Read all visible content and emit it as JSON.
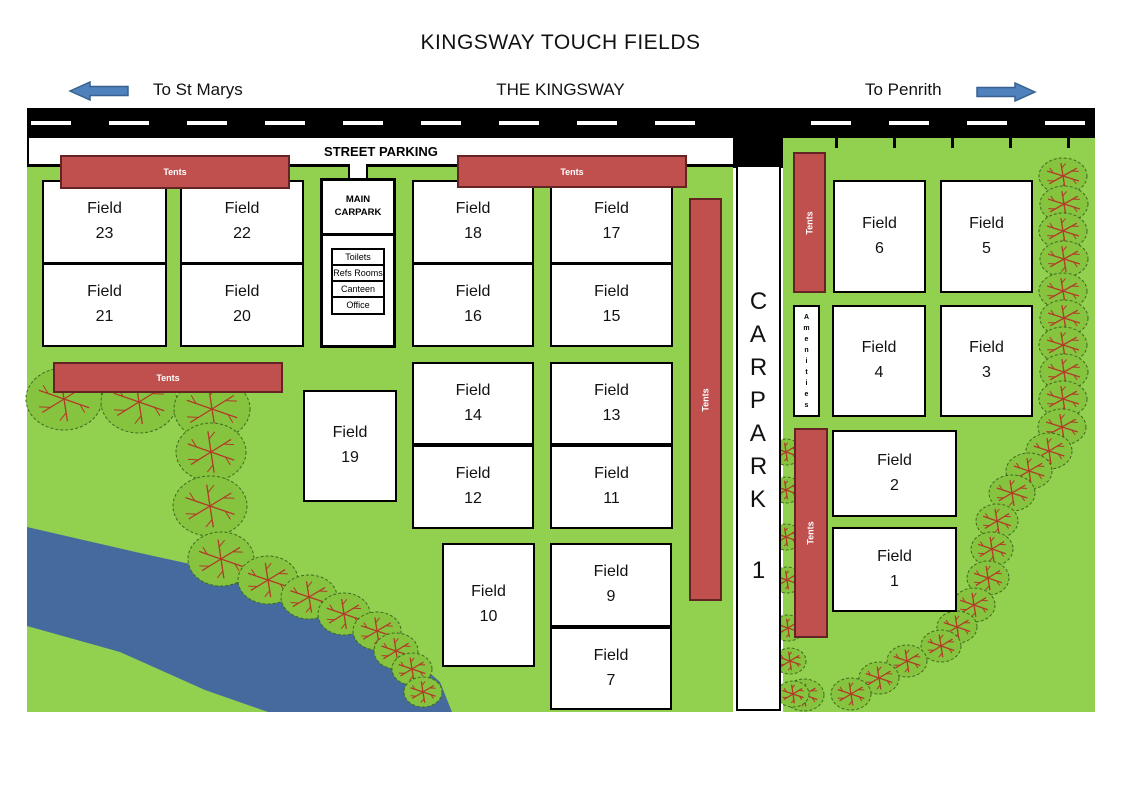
{
  "title": "KINGSWAY TOUCH FIELDS",
  "road": {
    "left_label": "To St Marys",
    "center_label": "THE KINGSWAY",
    "right_label": "To Penrith"
  },
  "street_parking_label": "STREET PARKING",
  "carpark1": {
    "letters": "CARPARK",
    "number": "1"
  },
  "main_carpark": {
    "label": "MAIN CARPARK",
    "rooms": [
      "Toilets",
      "Refs Rooms",
      "Canteen",
      "Office"
    ]
  },
  "amenities_label": "Amenities",
  "tents_label": "Tents",
  "field_word": "Field",
  "fields": [
    {
      "num": "23",
      "x": 42,
      "y": 180,
      "w": 125,
      "h": 84
    },
    {
      "num": "22",
      "x": 180,
      "y": 180,
      "w": 124,
      "h": 84
    },
    {
      "num": "21",
      "x": 42,
      "y": 263,
      "w": 125,
      "h": 84
    },
    {
      "num": "20",
      "x": 180,
      "y": 263,
      "w": 124,
      "h": 84
    },
    {
      "num": "18",
      "x": 412,
      "y": 180,
      "w": 122,
      "h": 84
    },
    {
      "num": "17",
      "x": 550,
      "y": 180,
      "w": 123,
      "h": 84
    },
    {
      "num": "16",
      "x": 412,
      "y": 263,
      "w": 122,
      "h": 84
    },
    {
      "num": "15",
      "x": 550,
      "y": 263,
      "w": 123,
      "h": 84
    },
    {
      "num": "14",
      "x": 412,
      "y": 362,
      "w": 122,
      "h": 83
    },
    {
      "num": "13",
      "x": 550,
      "y": 362,
      "w": 123,
      "h": 83
    },
    {
      "num": "12",
      "x": 412,
      "y": 445,
      "w": 122,
      "h": 84
    },
    {
      "num": "11",
      "x": 550,
      "y": 445,
      "w": 123,
      "h": 84
    },
    {
      "num": "19",
      "x": 303,
      "y": 390,
      "w": 94,
      "h": 112
    },
    {
      "num": "10",
      "x": 442,
      "y": 543,
      "w": 93,
      "h": 124
    },
    {
      "num": "9",
      "x": 550,
      "y": 543,
      "w": 122,
      "h": 84
    },
    {
      "num": "7",
      "x": 550,
      "y": 627,
      "w": 122,
      "h": 83
    },
    {
      "num": "6",
      "x": 833,
      "y": 180,
      "w": 93,
      "h": 113
    },
    {
      "num": "5",
      "x": 940,
      "y": 180,
      "w": 93,
      "h": 113
    },
    {
      "num": "4",
      "x": 832,
      "y": 305,
      "w": 94,
      "h": 112
    },
    {
      "num": "3",
      "x": 940,
      "y": 305,
      "w": 93,
      "h": 112
    },
    {
      "num": "2",
      "x": 832,
      "y": 430,
      "w": 125,
      "h": 87
    },
    {
      "num": "1",
      "x": 832,
      "y": 527,
      "w": 125,
      "h": 85
    }
  ],
  "tents": [
    {
      "x": 60,
      "y": 155,
      "w": 230,
      "h": 34,
      "vertical": false
    },
    {
      "x": 457,
      "y": 155,
      "w": 230,
      "h": 33,
      "vertical": false
    },
    {
      "x": 53,
      "y": 362,
      "w": 230,
      "h": 31,
      "vertical": false
    },
    {
      "x": 689,
      "y": 198,
      "w": 33,
      "h": 403,
      "vertical": true
    },
    {
      "x": 793,
      "y": 152,
      "w": 33,
      "h": 141,
      "vertical": true
    },
    {
      "x": 794,
      "y": 428,
      "w": 34,
      "h": 210,
      "vertical": true
    }
  ],
  "trees": [
    [
      64,
      399,
      38,
      31
    ],
    [
      139,
      402,
      38,
      31
    ],
    [
      212,
      409,
      38,
      31
    ],
    [
      211,
      452,
      35,
      29
    ],
    [
      210,
      506,
      37,
      30
    ],
    [
      221,
      559,
      33,
      27
    ],
    [
      268,
      580,
      30,
      24
    ],
    [
      309,
      597,
      28,
      22
    ],
    [
      344,
      614,
      26,
      21
    ],
    [
      377,
      631,
      24,
      19
    ],
    [
      396,
      651,
      22,
      18
    ],
    [
      412,
      669,
      20,
      16
    ],
    [
      423,
      692,
      19,
      15
    ],
    [
      1063,
      176,
      24,
      18
    ],
    [
      1064,
      204,
      24,
      18
    ],
    [
      1063,
      231,
      24,
      18
    ],
    [
      1064,
      259,
      24,
      18
    ],
    [
      1063,
      291,
      24,
      18
    ],
    [
      1064,
      318,
      24,
      18
    ],
    [
      1063,
      345,
      24,
      18
    ],
    [
      1064,
      372,
      24,
      18
    ],
    [
      1063,
      399,
      24,
      18
    ],
    [
      1062,
      427,
      24,
      18
    ],
    [
      1049,
      451,
      23,
      18
    ],
    [
      1029,
      471,
      23,
      18
    ],
    [
      1012,
      493,
      23,
      18
    ],
    [
      997,
      521,
      21,
      17
    ],
    [
      992,
      549,
      21,
      17
    ],
    [
      988,
      578,
      21,
      17
    ],
    [
      974,
      605,
      21,
      17
    ],
    [
      957,
      627,
      20,
      16
    ],
    [
      941,
      646,
      20,
      16
    ],
    [
      907,
      661,
      20,
      16
    ],
    [
      879,
      678,
      20,
      16
    ],
    [
      851,
      694,
      20,
      16
    ],
    [
      804,
      695,
      20,
      16
    ],
    [
      786,
      452,
      16,
      13
    ],
    [
      786,
      490,
      16,
      13
    ],
    [
      786,
      537,
      16,
      13
    ],
    [
      787,
      580,
      16,
      13
    ],
    [
      788,
      628,
      16,
      13
    ],
    [
      790,
      661,
      16,
      13
    ],
    [
      793,
      694,
      16,
      13
    ]
  ],
  "parking_ticks_x": [
    835,
    893,
    951,
    1009,
    1067
  ],
  "river_points": "27,527 140,553 240,575 330,612 400,647 440,682 452,712 268,712 205,690 120,652 27,626",
  "colors": {
    "grass": "#92D050",
    "tree": "#86C440",
    "tree_stroke": "#3E6B1E",
    "branch": "#B23A27",
    "tent_fill": "#C0504D",
    "tent_stroke": "#632423",
    "river": "#456A9E",
    "arrow_fill": "#4F81BD",
    "arrow_stroke": "#38618F"
  }
}
